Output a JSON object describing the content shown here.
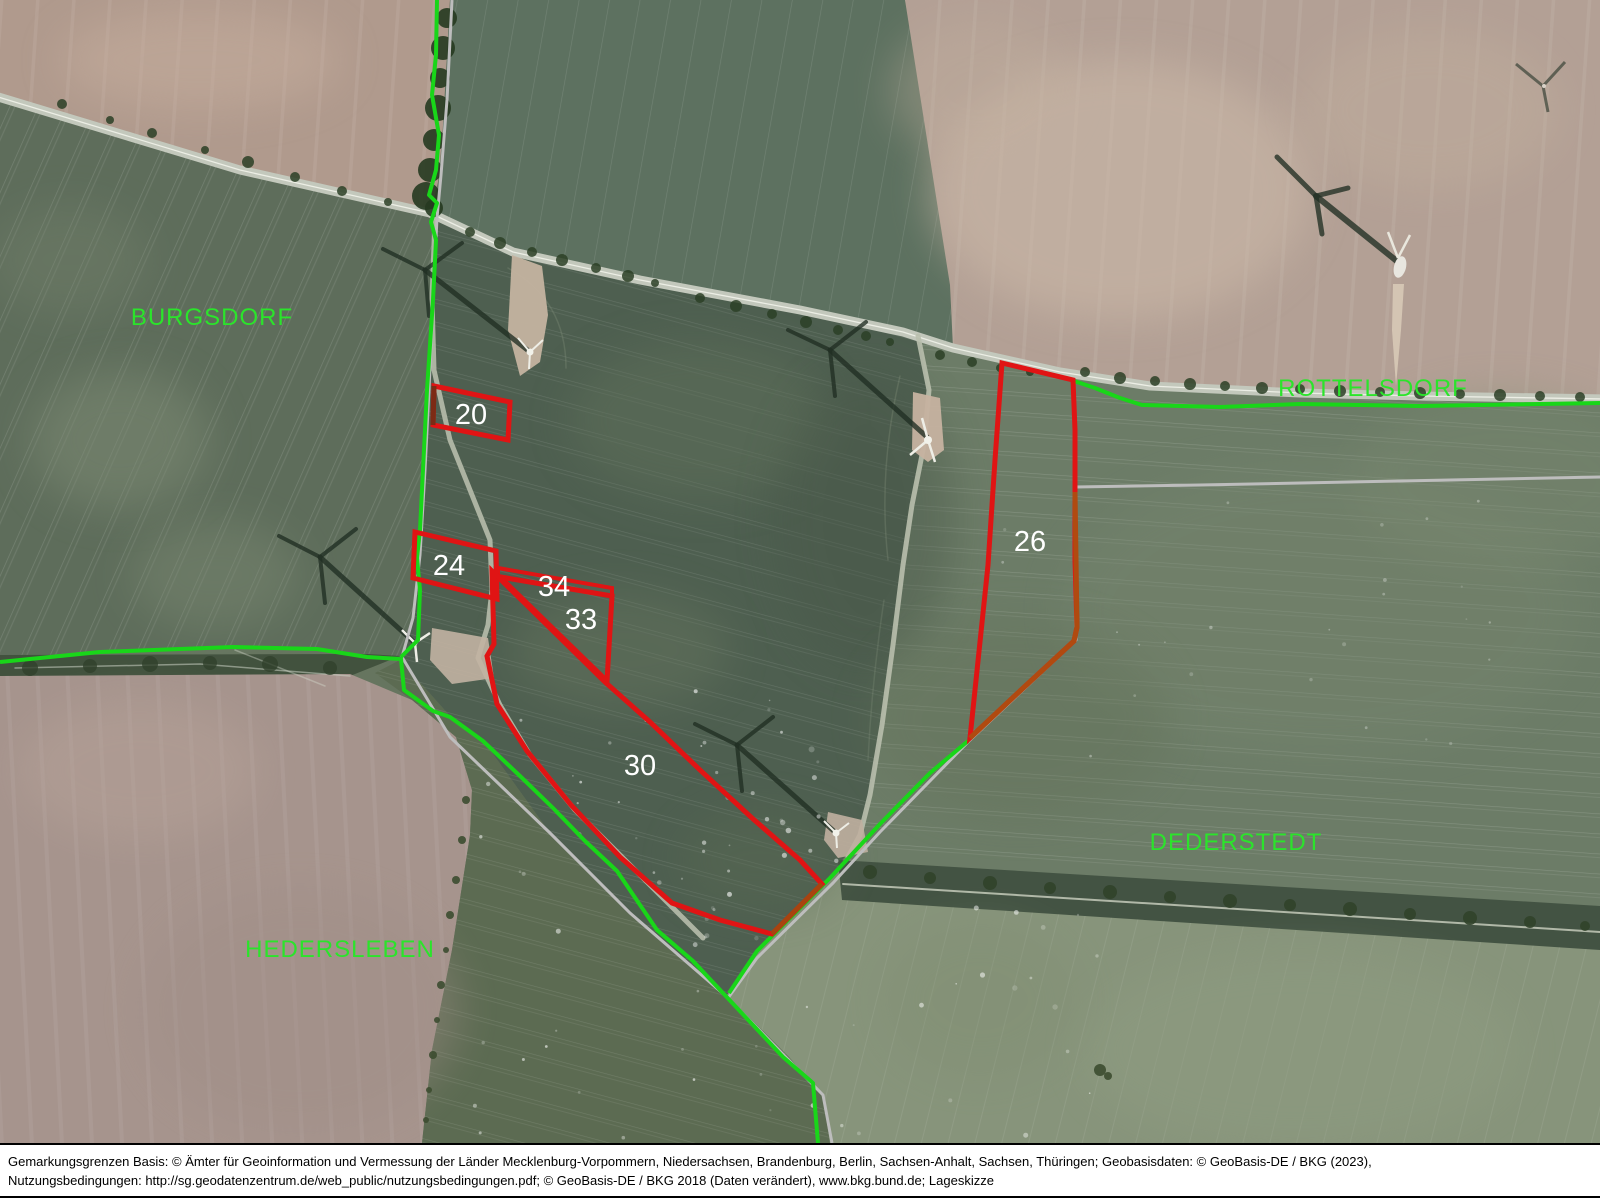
{
  "map": {
    "title": "Lageskizze",
    "place_labels": [
      {
        "label": "BURGSDORF"
      },
      {
        "label": "ROTTELSDORF"
      },
      {
        "label": "DEDERSTEDT"
      },
      {
        "label": "HEDERSLEBEN"
      }
    ],
    "parcels": [
      {
        "id": "20"
      },
      {
        "id": "24"
      },
      {
        "id": "34"
      },
      {
        "id": "33"
      },
      {
        "id": "30"
      },
      {
        "id": "26"
      }
    ],
    "overlay_colors": {
      "parcel_outline_red": "#e01414",
      "boundary_green": "#19d619",
      "boundary_gray": "#bdbdbd",
      "place_label_green": "#2be42b",
      "parcel_label_white": "#ffffff"
    }
  },
  "footer": {
    "line1": "Gemarkungsgrenzen Basis: © Ämter für Geoinformation und Vermessung der Länder Mecklenburg-Vorpommern, Niedersachsen, Brandenburg, Berlin, Sachsen-Anhalt, Sachsen, Thüringen; Geobasisdaten: © GeoBasis-DE / BKG (2023),",
    "line2": "Nutzungsbedingungen: http://sg.geodatenzentrum.de/web_public/nutzungsbedingungen.pdf; © GeoBasis-DE / BKG 2018 (Daten verändert), www.bkg.bund.de; Lageskizze"
  }
}
